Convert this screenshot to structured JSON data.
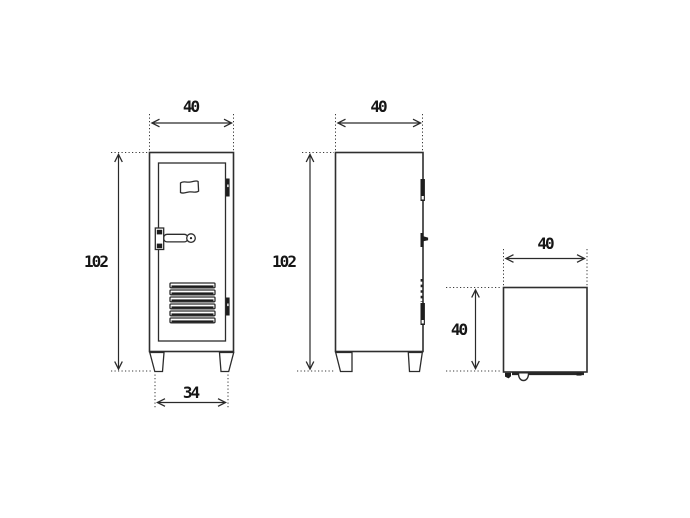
{
  "page": {
    "background": "#ffffff"
  },
  "drawing": {
    "line_color": "#2f2f2f",
    "text_color": "#161616",
    "dims": {
      "front_width": "40",
      "front_height": "102",
      "feet_width": "34",
      "side_depth": "40",
      "side_height": "102",
      "top_width": "40",
      "top_depth": "40"
    }
  }
}
